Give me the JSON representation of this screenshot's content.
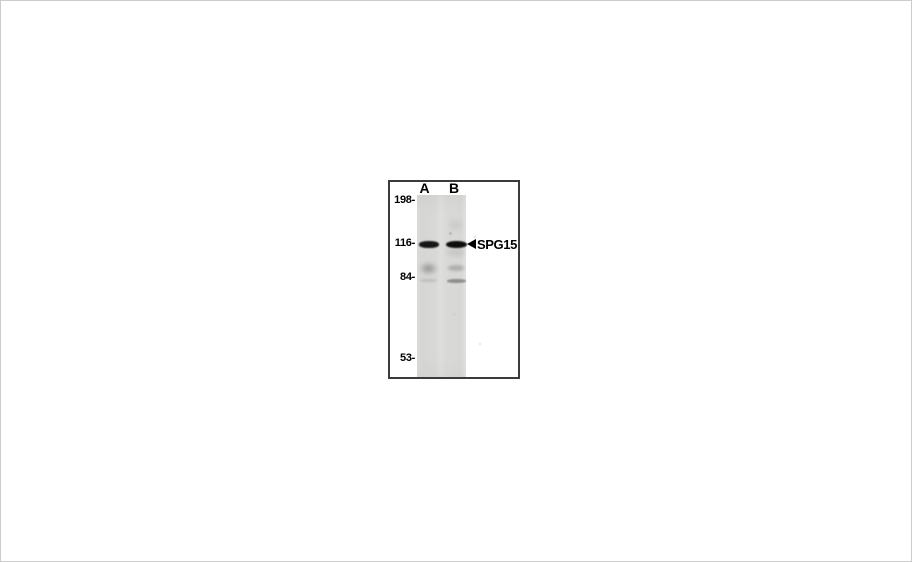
{
  "figure": {
    "type": "western-blot",
    "lane_labels": [
      "A",
      "B"
    ],
    "mw_markers": [
      "198-",
      "116-",
      "84-",
      "53-"
    ],
    "annotation": {
      "icon": "left-arrowhead-icon",
      "label": "SPG15"
    },
    "bands": [
      {
        "lane": "A",
        "approx_kda": 116,
        "intensity": "strong"
      },
      {
        "lane": "B",
        "approx_kda": 116,
        "intensity": "strong"
      },
      {
        "lane": "A",
        "approx_kda": 90,
        "intensity": "faint-smear"
      },
      {
        "lane": "B",
        "approx_kda": 88,
        "intensity": "faint"
      },
      {
        "lane": "B",
        "approx_kda": 82,
        "intensity": "faint"
      }
    ],
    "colors": {
      "background": "#ffffff",
      "frame_border": "#3b3b3b",
      "membrane": "#d9d9d7",
      "band": "#141414",
      "text": "#000000"
    }
  }
}
